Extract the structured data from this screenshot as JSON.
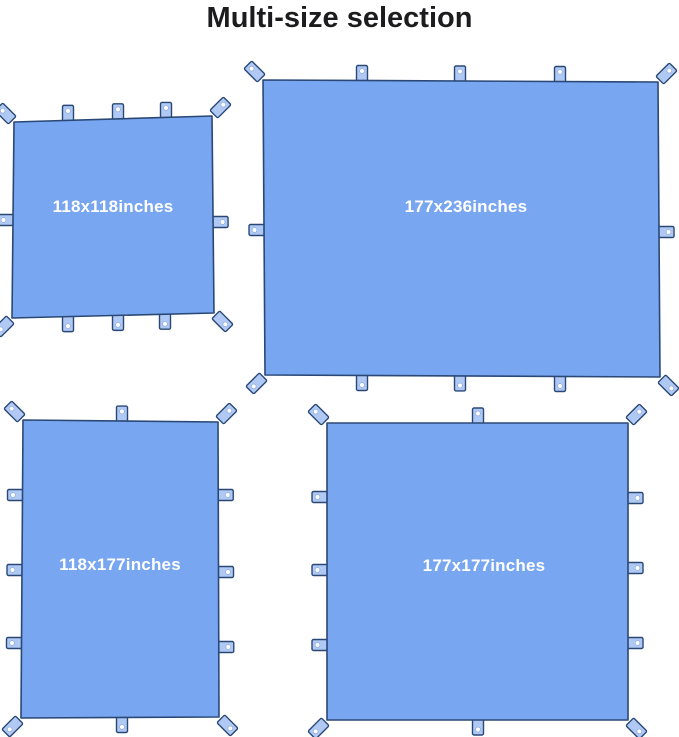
{
  "title": "Multi-size selection",
  "colors": {
    "tarp_fill": "#79A6F1",
    "tarp_border": "#2A4876",
    "tab_fill": "#AFC9F4",
    "grommet": "#FFFFFF",
    "label_text": "#FFFFFF",
    "title_text": "#1C1C1E",
    "background": "#FFFFFF"
  },
  "tarps": [
    {
      "id": "118x118",
      "label": "118x118inches",
      "width_inches": 118,
      "height_inches": 118
    },
    {
      "id": "177x236",
      "label": "177x236inches",
      "width_inches": 177,
      "height_inches": 236
    },
    {
      "id": "118x177",
      "label": "118x177inches",
      "width_inches": 118,
      "height_inches": 177
    },
    {
      "id": "177x177",
      "label": "177x177inches",
      "width_inches": 177,
      "height_inches": 177
    }
  ]
}
